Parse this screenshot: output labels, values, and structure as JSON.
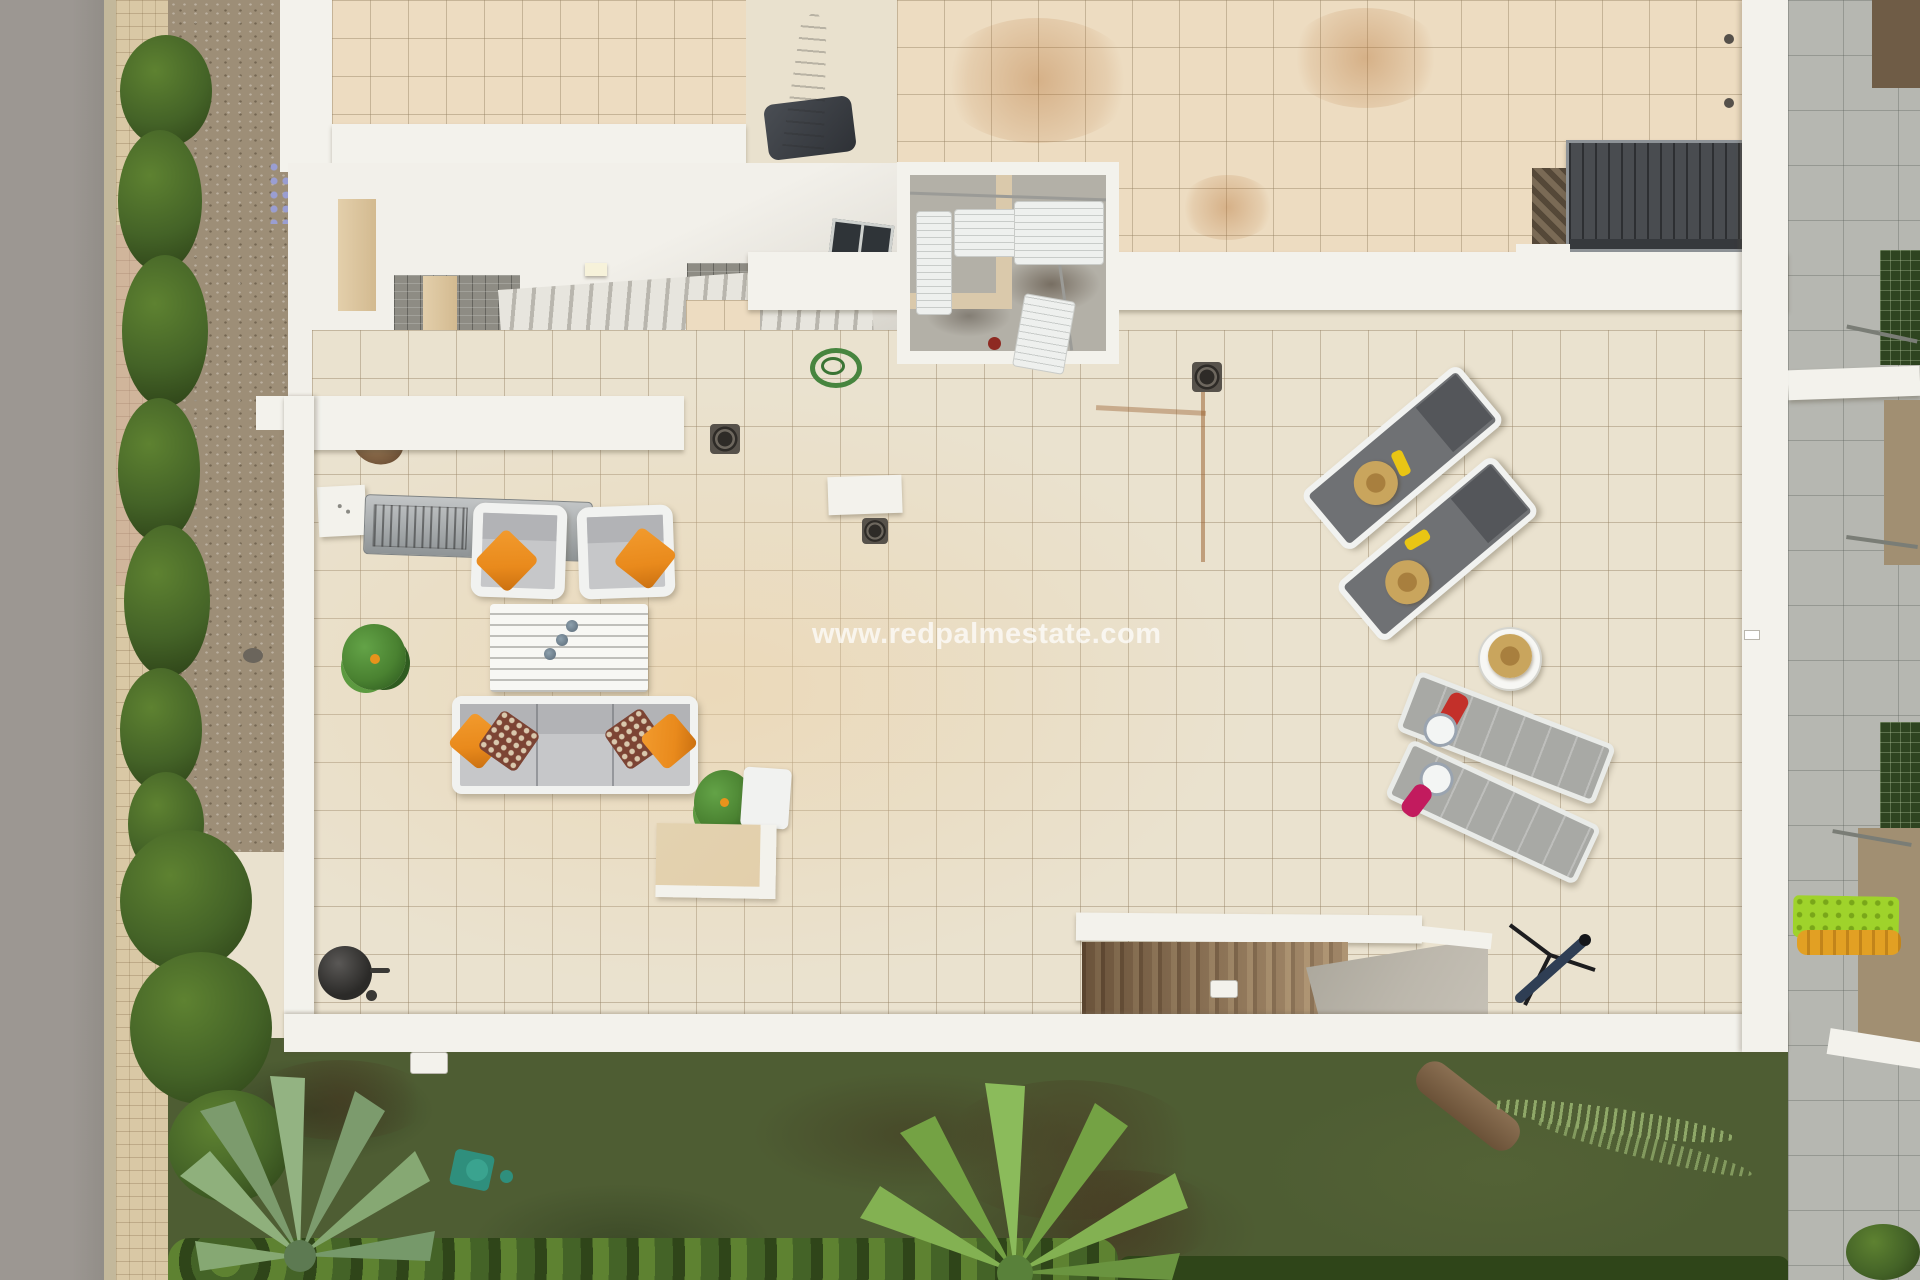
{
  "image": {
    "type": "aerial-real-estate-photograph",
    "subject": "Top-down drone view of a modern villa rooftop solarium terrace with outdoor furniture, garden, hedges and street",
    "width_px": 1920,
    "height_px": 1280
  },
  "watermark": {
    "text": "www.redpalmestate.com"
  },
  "palette": {
    "road": "#9c9792",
    "road_edge": "#c3b89b",
    "sidewalk": "#d9c8a5",
    "sidewalk_pink": "#c59d90",
    "gravel": "#9d8e77",
    "hedge_dark": "#2f4519",
    "hedge_mid": "#446327",
    "hedge_bright": "#5e8231",
    "grass": "#4e5d33",
    "tile_main": "#eae2cf",
    "tile_warm": "#eddcc1",
    "parapet": "#f3f2ec",
    "plane_white": "#f2f0ea",
    "stone": "#8e8c84",
    "pillar": "#e3cfab",
    "step_light": "#e7e5de",
    "step_shadow": "#b9b6ae",
    "brown_steps_dark": "#6e563f",
    "brown_steps_mid": "#8a7055",
    "brown_steps_light": "#a08768",
    "landing": "#bcb7ac",
    "pergola": "#494c50",
    "neighbor": "#b6b7b1",
    "soil": "#6f5c46",
    "enclosure_floor": "#b3b0a7",
    "partition": "#dac9ab",
    "ac_white": "#eef0ee",
    "cushion": "#c6c7c9",
    "cushion_dark": "#b2b3b6",
    "frame_white": "#f1f2f0",
    "orange": "#e98a1c",
    "pattern_brown": "#7c4434",
    "pattern_dot": "#d9c8ad",
    "table_white": "#f7f7f4",
    "plant_green": "#4a8231",
    "plant_dark": "#2f5c20",
    "lounger_dark": "#6f7174",
    "lounger_head": "#54565a",
    "lounger_light": "#a8a9a5",
    "hat": "#c9a55d",
    "hat_dark": "#a87f3e",
    "yellow": "#e9c514",
    "red": "#c3302a",
    "pink": "#c21b5e",
    "plate": "#f3f5f4",
    "bbq": "#2b2a28",
    "blue_tube": "#2f3e54",
    "teal": "#2f8f7d",
    "lime": "#9fd32b",
    "lilo": "#e2a023",
    "watermark_color": "#ffffff"
  },
  "objects": {
    "list": [
      "street",
      "sidewalk",
      "hedge-row",
      "gravel-bed",
      "upper-roof-terrace",
      "entrance-canopy-with-skylight",
      "exterior-staircase",
      "technical-enclosure-with-ac-units",
      "louvered-pergola",
      "folded-parasol",
      "main-roof-terrace",
      "outdoor-kitchen-grill",
      "lounge-armchairs",
      "slatted-coffee-table",
      "three-seat-sofa",
      "potted-plants",
      "concrete-bench",
      "kettle-barbecue",
      "telescope",
      "dark-sun-lounger-pair",
      "light-sun-lounger-pair",
      "round-side-table",
      "straw-hats",
      "garden-stairwell",
      "lawn-garden",
      "fan-palms",
      "neighbor-terrace",
      "lime-green-sunbed"
    ]
  }
}
